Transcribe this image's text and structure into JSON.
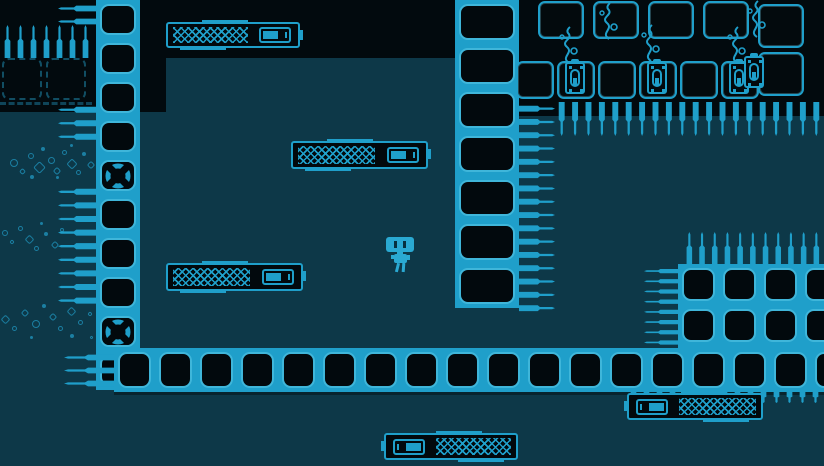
{
  "meta": {
    "viewport_width": 824,
    "viewport_height": 466
  },
  "palette": {
    "background_teal": "#0d3848",
    "void_black": "#020a0e",
    "cyan": "#1f9fca",
    "cyan_bright": "#3fb6da",
    "cyan_dim": "#155f79",
    "bubble": "#1b7fa2",
    "robot_body": "#2aa9d2",
    "underfloor_shadow": "#08242e"
  },
  "scene": {
    "black_regions": [
      {
        "name": "void-top-left",
        "x": 0,
        "y": 0,
        "w": 166,
        "h": 112,
        "c": "#020a0e"
      },
      {
        "name": "void-top-center",
        "x": 140,
        "y": 0,
        "w": 320,
        "h": 58,
        "c": "#020a0e"
      },
      {
        "name": "void-top-right",
        "x": 455,
        "y": 0,
        "w": 369,
        "h": 116,
        "c": "#020a0e"
      },
      {
        "name": "underfloor-line",
        "x": 114,
        "y": 390,
        "w": 710,
        "h": 5,
        "c": "#08242e"
      }
    ],
    "tile_strips": [
      {
        "name": "wall-left",
        "x": 96,
        "y": 0,
        "dir": "v",
        "thickness": 44,
        "tiles": 10,
        "pitch": 39,
        "fans": [
          4,
          8
        ]
      },
      {
        "name": "wall-right",
        "x": 455,
        "y": 0,
        "dir": "v",
        "thickness": 64,
        "tiles": 7,
        "pitch": 44,
        "fans": []
      },
      {
        "name": "floor",
        "x": 114,
        "y": 348,
        "dir": "h",
        "thickness": 44,
        "tiles": 18,
        "pitch": 41,
        "fans": []
      }
    ],
    "grids": [
      {
        "name": "block-bottom-right",
        "x": 678,
        "y": 264,
        "cols": 4,
        "rows": 2,
        "pitch": 41
      }
    ],
    "outline_tiles": [
      {
        "x": 538,
        "y": 1,
        "w": 46,
        "h": 38
      },
      {
        "x": 593,
        "y": 1,
        "w": 46,
        "h": 38
      },
      {
        "x": 648,
        "y": 1,
        "w": 46,
        "h": 38
      },
      {
        "x": 703,
        "y": 1,
        "w": 46,
        "h": 38
      },
      {
        "x": 758,
        "y": 4,
        "w": 46,
        "h": 44
      },
      {
        "x": 758,
        "y": 52,
        "w": 46,
        "h": 44
      },
      {
        "x": 516,
        "y": 61,
        "w": 38,
        "h": 38
      },
      {
        "x": 557,
        "y": 61,
        "w": 38,
        "h": 38
      },
      {
        "x": 598,
        "y": 61,
        "w": 38,
        "h": 38
      },
      {
        "x": 639,
        "y": 61,
        "w": 38,
        "h": 38
      },
      {
        "x": 680,
        "y": 61,
        "w": 38,
        "h": 38
      },
      {
        "x": 721,
        "y": 61,
        "w": 38,
        "h": 38
      }
    ],
    "faded_tiles": [
      {
        "x": 2,
        "y": 58,
        "w": 40,
        "h": 42,
        "strip": false
      },
      {
        "x": 46,
        "y": 58,
        "w": 40,
        "h": 42,
        "strip": false
      },
      {
        "x": 0,
        "y": 102,
        "w": 92,
        "h": 9,
        "strip": true
      }
    ],
    "spike_rows": [
      {
        "name": "spikes-wall-left-top",
        "dir": "left",
        "x": 58,
        "y": 3,
        "count": 2,
        "pitch": 13,
        "len": 38
      },
      {
        "name": "spikes-up-top-left",
        "dir": "up",
        "x": 2,
        "y": 25,
        "count": 7,
        "pitch": 13,
        "len": 33
      },
      {
        "name": "spikes-wall-left-mid",
        "dir": "left",
        "x": 58,
        "y": 104,
        "count": 3,
        "pitch": 13.5,
        "len": 38
      },
      {
        "name": "spikes-wall-left-low",
        "dir": "left",
        "x": 58,
        "y": 186,
        "count": 9,
        "pitch": 13.6,
        "len": 38
      },
      {
        "name": "spikes-floor-left-end",
        "dir": "left",
        "x": 64,
        "y": 352,
        "count": 3,
        "pitch": 13,
        "len": 50
      },
      {
        "name": "spikes-wall-right",
        "dir": "right",
        "x": 519,
        "y": 103,
        "count": 16,
        "pitch": 13.3,
        "len": 36
      },
      {
        "name": "spikes-ceiling-right",
        "dir": "down",
        "x": 556,
        "y": 102,
        "count": 20,
        "pitch": 13.4,
        "len": 34
      },
      {
        "name": "spikes-block-top",
        "dir": "up",
        "x": 684,
        "y": 232,
        "count": 11,
        "pitch": 12.7,
        "len": 32
      },
      {
        "name": "spikes-block-left",
        "dir": "left",
        "x": 644,
        "y": 267,
        "count": 8,
        "pitch": 10.2,
        "len": 34
      },
      {
        "name": "spikes-under-floor",
        "dir": "down",
        "x": 628,
        "y": 390,
        "count": 15,
        "pitch": 13,
        "len": 13
      }
    ],
    "platforms": [
      {
        "name": "zipper-platform-1",
        "x": 166,
        "y": 22,
        "w": 134,
        "h": 26,
        "flip": false
      },
      {
        "name": "zipper-platform-2",
        "x": 291,
        "y": 141,
        "w": 137,
        "h": 28,
        "flip": false
      },
      {
        "name": "zipper-platform-3",
        "x": 166,
        "y": 263,
        "w": 137,
        "h": 28,
        "flip": false
      },
      {
        "name": "zipper-platform-4",
        "x": 627,
        "y": 393,
        "w": 136,
        "h": 27,
        "flip": true
      },
      {
        "name": "zipper-platform-5",
        "x": 384,
        "y": 433,
        "w": 134,
        "h": 27,
        "flip": true
      }
    ],
    "robot": {
      "x": 386,
      "y": 237
    },
    "torches": [
      {
        "x": 565,
        "y": 62
      },
      {
        "x": 647,
        "y": 62
      },
      {
        "x": 729,
        "y": 62
      },
      {
        "x": 744,
        "y": 56
      }
    ],
    "wisps": [
      {
        "x": 556,
        "y": 26
      },
      {
        "x": 596,
        "y": 2
      },
      {
        "x": 638,
        "y": 24
      },
      {
        "x": 724,
        "y": 26
      },
      {
        "x": 744,
        "y": 0
      }
    ],
    "bubble_clusters": [
      {
        "name": "bubbles-left-upper",
        "x": 8,
        "y": 143,
        "bubbles": [
          [
            2,
            16,
            8,
            0
          ],
          [
            12,
            26,
            5,
            1
          ],
          [
            20,
            10,
            6,
            0
          ],
          [
            27,
            20,
            9,
            1
          ],
          [
            33,
            4,
            4,
            2
          ],
          [
            40,
            14,
            7,
            0
          ],
          [
            46,
            25,
            6,
            1
          ],
          [
            54,
            7,
            5,
            0
          ],
          [
            60,
            17,
            8,
            1
          ],
          [
            68,
            27,
            5,
            0
          ],
          [
            74,
            9,
            4,
            2
          ],
          [
            80,
            19,
            6,
            1
          ],
          [
            62,
            1,
            3,
            2
          ],
          [
            22,
            32,
            4,
            2
          ],
          [
            48,
            33,
            3,
            2
          ]
        ]
      },
      {
        "name": "bubbles-left-mid",
        "x": 0,
        "y": 220,
        "bubbles": [
          [
            2,
            10,
            6,
            0
          ],
          [
            10,
            20,
            4,
            1
          ],
          [
            18,
            6,
            5,
            0
          ],
          [
            26,
            16,
            7,
            1
          ],
          [
            34,
            26,
            5,
            0
          ],
          [
            44,
            12,
            4,
            2
          ],
          [
            52,
            22,
            6,
            1
          ],
          [
            60,
            8,
            4,
            0
          ],
          [
            40,
            2,
            3,
            2
          ]
        ]
      },
      {
        "name": "bubbles-left-lower",
        "x": 0,
        "y": 296,
        "bubbles": [
          [
            2,
            20,
            7,
            1
          ],
          [
            12,
            30,
            5,
            0
          ],
          [
            22,
            14,
            6,
            1
          ],
          [
            32,
            24,
            8,
            0
          ],
          [
            42,
            8,
            4,
            2
          ],
          [
            50,
            18,
            6,
            1
          ],
          [
            58,
            30,
            5,
            0
          ],
          [
            68,
            12,
            7,
            1
          ],
          [
            78,
            24,
            5,
            0
          ],
          [
            88,
            16,
            4,
            1
          ],
          [
            96,
            28,
            6,
            0
          ],
          [
            104,
            18,
            4,
            2
          ],
          [
            70,
            38,
            4,
            2
          ],
          [
            30,
            40,
            3,
            2
          ],
          [
            90,
            40,
            3,
            1
          ]
        ]
      }
    ]
  }
}
